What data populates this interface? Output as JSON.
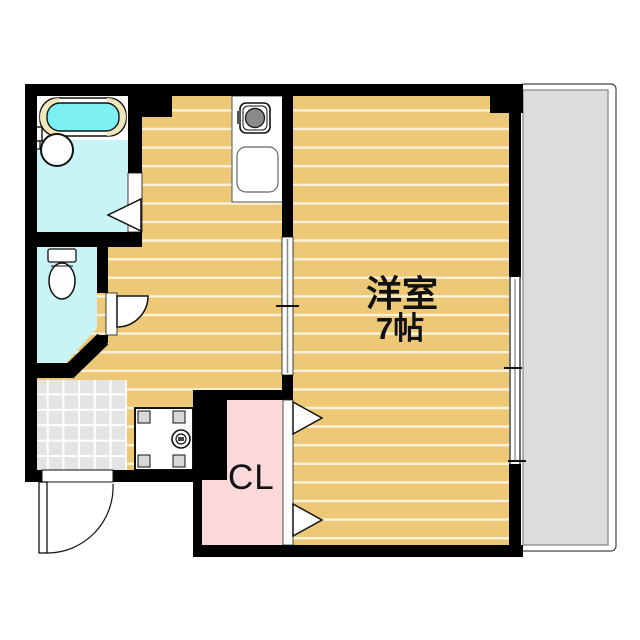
{
  "plan": {
    "title": "1K apartment floor plan",
    "labels": {
      "main_room_name": "洋室",
      "main_room_size": "7帖",
      "closet": "CL"
    },
    "rooms": [
      {
        "name": "western-room",
        "label": "洋室 7帖",
        "floor": "wood flooring"
      },
      {
        "name": "kitchen-hallway",
        "floor": "wood flooring"
      },
      {
        "name": "bathroom",
        "floor": "wet-area cyan"
      },
      {
        "name": "toilet-room",
        "floor": "wet-area cyan"
      },
      {
        "name": "closet",
        "label": "CL",
        "floor": "pink"
      },
      {
        "name": "entrance-genkan",
        "floor": "gray tile"
      },
      {
        "name": "balcony",
        "floor": "gray"
      }
    ],
    "fixtures": [
      "bathtub",
      "washbasin",
      "bath-faucet",
      "toilet-bowl",
      "toilet-tank",
      "gas-stove",
      "kitchen-sink",
      "kitchen-counter",
      "washing-machine-pan",
      "drain",
      "entrance-door-swing",
      "toilet-door-swing",
      "bathroom-door",
      "sliding-door",
      "closet-folding-door",
      "sliding-window"
    ],
    "colors": {
      "wall": "#000000",
      "flooring": "#ecc877",
      "flooring_line": "#faf3da",
      "wet_area": "#c8f4f6",
      "bathtub_water": "#7df0f2",
      "bathtub_rim": "#f0e6bc",
      "closet_pink": "#fbd8da",
      "entrance_tile": "#e4e4e4",
      "balcony_gray": "#dcdcdc",
      "fixture_white": "#ffffff"
    }
  }
}
